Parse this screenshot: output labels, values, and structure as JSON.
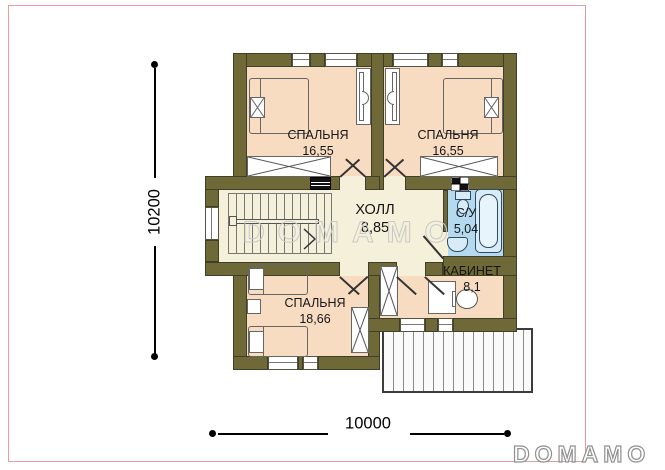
{
  "watermark": {
    "text": "DOMAMO"
  },
  "logo": {
    "text": "DOMAMO"
  },
  "dimensions": {
    "vertical": "10200",
    "horizontal": "10000"
  },
  "rooms": [
    {
      "name": "СПАЛЬНЯ",
      "area": "16,55"
    },
    {
      "name": "СПАЛЬНЯ",
      "area": "16,55"
    },
    {
      "name": "ХОЛЛ",
      "area": "8,85"
    },
    {
      "name": "С/У",
      "area": "5,04"
    },
    {
      "name": "КАБИНЕТ",
      "area": "8,1"
    },
    {
      "name": "СПАЛЬНЯ",
      "area": "18,66"
    }
  ],
  "colors": {
    "wall": "#6f6937",
    "wall-edge": "#3e3e2b",
    "room-peach": "#f8dcc2",
    "room-cream": "#f4f0da",
    "room-blue": "#b5d9ef",
    "fixture-blue": "#2e4b66",
    "frame-pink": "#e49c9c",
    "line-dark": "#333333",
    "watermark-gray": "#c9c9c9",
    "logo-gray": "#8f8f8f"
  }
}
